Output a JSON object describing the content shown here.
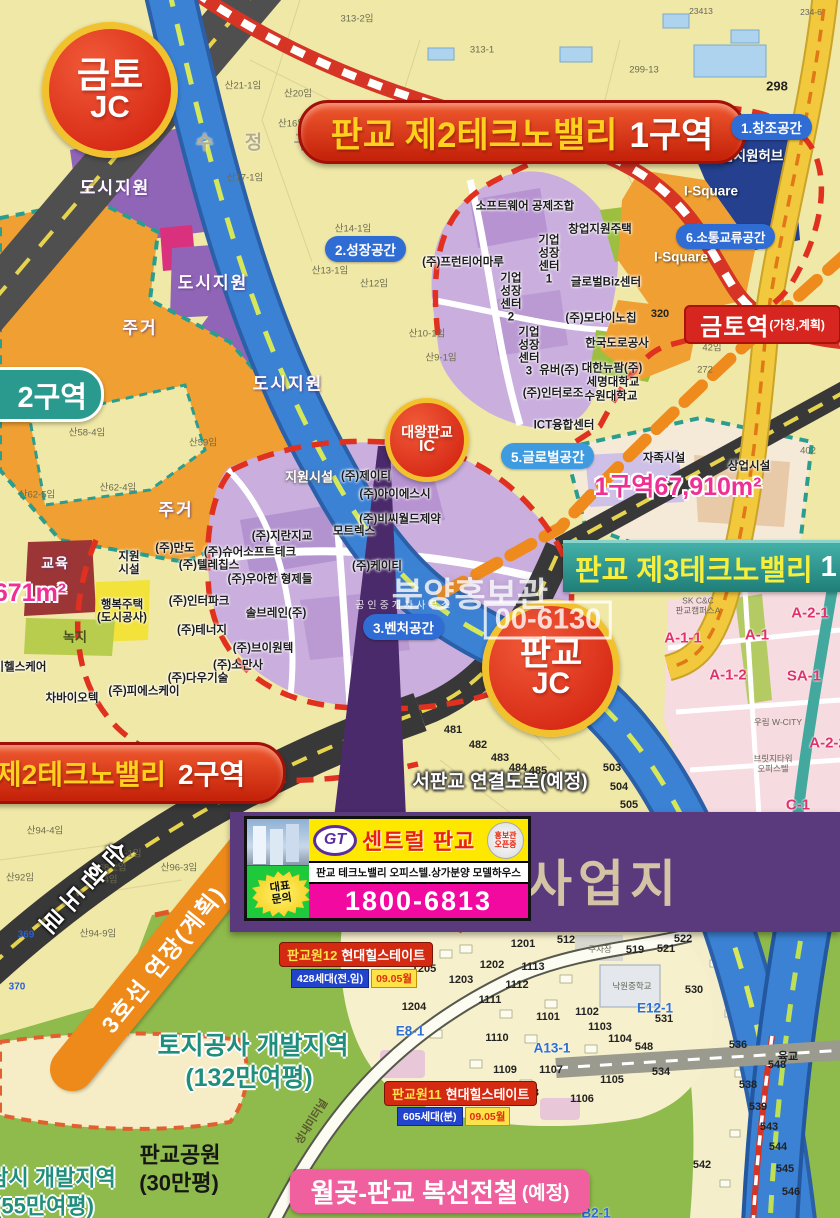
{
  "palette": {
    "map_bg": "#f0e8a6",
    "zone_residential": "#f0a032",
    "zone_urban_support": "#9065b8",
    "zone_company": "#c9aede",
    "zone_hub_navy": "#24408e",
    "expressway_blue": "#3b82d4",
    "banner_red": "#d5301c",
    "banner_teal": "#2e9599",
    "badge_blue": "#2f6cd4",
    "accent_pink": "#ef2f94",
    "park_green": "#8fba4c",
    "ad_magenta": "#f20aa0",
    "ad_yellow": "#ffe800",
    "site_band_purple": "#5a3a7d"
  },
  "junctions": {
    "geumto_jc": {
      "line1": "금토",
      "line2": "JC"
    },
    "pangyo_jc": {
      "line1": "판교",
      "line2": "JC"
    },
    "daewang_ic": {
      "line1": "대왕판교",
      "line2": "IC"
    }
  },
  "banners": {
    "tv2_zone1": {
      "prefix": "판교 제2테크노밸리",
      "suffix": "1구역"
    },
    "tv2_zone2": {
      "prefix": "제2테크노밸리",
      "suffix": "2구역"
    },
    "tv3": {
      "text": "판교 제3테크노밸리",
      "suffix": "1"
    },
    "zone2_badge": "2구역",
    "wolgot": {
      "text": "월곶-판교 복선전철",
      "note": "(예정)"
    }
  },
  "station": {
    "name": "금토역",
    "note": "(가칭,계획)"
  },
  "space_badges": {
    "s1": "1.창조공간",
    "s2": "2.성장공간",
    "s3": "3.벤처공간",
    "s5": "5.글로벌공간",
    "s6": "6.소통교류공간"
  },
  "ad": {
    "logo": "GT",
    "brand": "센트럴 판교",
    "ribbon_line1": "홍보관",
    "ribbon_line2": "오픈중",
    "desc": "판교 테크노밸리 오피스텔.상가분양 모델하우스",
    "contact_line1": "대표",
    "contact_line2": "문의",
    "phone": "1800-6813"
  },
  "site_label": "사업지",
  "apartments": {
    "pg12": {
      "name_prefix": "판교원12",
      "name": "현대힐스테이트",
      "units": "428세대(전.임)",
      "date": "09.05월"
    },
    "pg11": {
      "name_prefix": "판교원11",
      "name": "현대힐스테이트",
      "units": "605세대(분)",
      "date": "09.05월"
    }
  },
  "roads": {
    "ring": "순환도로",
    "line3": "3호선 연장(계획)"
  },
  "watermark": {
    "line1": "분양홍보관",
    "line2": "공인중개사사무소",
    "line3": "00-6130"
  },
  "map_labels": [
    {
      "t": "지원시설",
      "x": 309,
      "y": 478,
      "c": "co-w"
    },
    {
      "t": "(주)제이티",
      "x": 366,
      "y": 477,
      "c": "co"
    },
    {
      "t": "(주)아이에스시",
      "x": 395,
      "y": 495,
      "c": "co"
    },
    {
      "t": "(주)비씨월드제약",
      "x": 400,
      "y": 520,
      "c": "co"
    },
    {
      "t": "모트렉스",
      "x": 354,
      "y": 532,
      "c": "co"
    },
    {
      "t": "(주)지란지교",
      "x": 282,
      "y": 537,
      "c": "co"
    },
    {
      "t": "(주)만도",
      "x": 175,
      "y": 549,
      "c": "co"
    },
    {
      "t": "(주)슈어소프트테크",
      "x": 250,
      "y": 553,
      "c": "co"
    },
    {
      "t": "(주)텔레칩스",
      "x": 209,
      "y": 566,
      "c": "co"
    },
    {
      "t": "(주)우아한 형제들",
      "x": 270,
      "y": 580,
      "c": "co"
    },
    {
      "t": "(주)인터파크",
      "x": 199,
      "y": 602,
      "c": "co"
    },
    {
      "t": "솔브레인(주)",
      "x": 276,
      "y": 614,
      "c": "co"
    },
    {
      "t": "(주)테너지",
      "x": 202,
      "y": 631,
      "c": "co"
    },
    {
      "t": "(주)브이원텍",
      "x": 263,
      "y": 649,
      "c": "co"
    },
    {
      "t": "(주)소만사",
      "x": 238,
      "y": 666,
      "c": "co"
    },
    {
      "t": "(주)다우기술",
      "x": 198,
      "y": 679,
      "c": "co"
    },
    {
      "t": "(주)피에스케이",
      "x": 144,
      "y": 692,
      "c": "co"
    },
    {
      "t": "차바이오텍",
      "x": 72,
      "y": 699,
      "c": "co"
    },
    {
      "t": "이헬스케어",
      "x": 20,
      "y": 668,
      "c": "co"
    },
    {
      "t": "(주)케이티",
      "x": 377,
      "y": 567,
      "c": "co"
    },
    {
      "t": "행복주택\n(도시공사)",
      "x": 122,
      "y": 612,
      "c": "co"
    },
    {
      "t": "지원\n시설",
      "x": 129,
      "y": 564,
      "c": "co"
    },
    {
      "t": "소프트웨어 공제조합",
      "x": 525,
      "y": 207,
      "c": "co"
    },
    {
      "t": "창업지원주택",
      "x": 600,
      "y": 230,
      "c": "co"
    },
    {
      "t": "(주)프런티어마루",
      "x": 463,
      "y": 263,
      "c": "co"
    },
    {
      "t": "기업\n성장\n센터\n1",
      "x": 549,
      "y": 260,
      "c": "co"
    },
    {
      "t": "기업\n성장\n센터\n2",
      "x": 511,
      "y": 298,
      "c": "co"
    },
    {
      "t": "기업\n성장\n센터\n3",
      "x": 529,
      "y": 352,
      "c": "co"
    },
    {
      "t": "글로벌Biz센터",
      "x": 606,
      "y": 283,
      "c": "co"
    },
    {
      "t": "(주)모다이노칩",
      "x": 601,
      "y": 319,
      "c": "co"
    },
    {
      "t": "한국도로공사",
      "x": 617,
      "y": 344,
      "c": "co"
    },
    {
      "t": "유버(주)",
      "x": 559,
      "y": 371,
      "c": "co"
    },
    {
      "t": "대한뉴팜(주)",
      "x": 612,
      "y": 369,
      "c": "co"
    },
    {
      "t": "세명대학교",
      "x": 613,
      "y": 383,
      "c": "co"
    },
    {
      "t": "(주)인터로조",
      "x": 553,
      "y": 394,
      "c": "co"
    },
    {
      "t": "수원대학교",
      "x": 611,
      "y": 397,
      "c": "co"
    },
    {
      "t": "ICT융합센터",
      "x": 564,
      "y": 426,
      "c": "co"
    },
    {
      "t": "자족시설",
      "x": 664,
      "y": 459,
      "c": "co"
    },
    {
      "t": "상업시설",
      "x": 749,
      "y": 467,
      "c": "co"
    },
    {
      "t": "기업지원허브",
      "x": 746,
      "y": 156,
      "c": "co-wt"
    },
    {
      "t": "I-Square",
      "x": 711,
      "y": 191,
      "c": "co-wt"
    },
    {
      "t": "I-Square",
      "x": 681,
      "y": 257,
      "c": "co-wt"
    },
    {
      "t": "도시지원",
      "x": 115,
      "y": 188,
      "c": "ar"
    },
    {
      "t": "도시지원",
      "x": 213,
      "y": 283,
      "c": "ar"
    },
    {
      "t": "도시지원",
      "x": 288,
      "y": 384,
      "c": "ar"
    },
    {
      "t": "주거",
      "x": 140,
      "y": 328,
      "c": "ar"
    },
    {
      "t": "주거",
      "x": 176,
      "y": 510,
      "c": "ar"
    },
    {
      "t": "교육",
      "x": 55,
      "y": 564,
      "c": "ar ar-sm"
    },
    {
      "t": "녹지",
      "x": 75,
      "y": 638,
      "c": "ar-g"
    },
    {
      "t": "수 정 구",
      "x": 260,
      "y": 143,
      "c": "gu"
    },
    {
      "t": "671m²",
      "x": 30,
      "y": 593,
      "c": "pink-big"
    },
    {
      "t": "1구역67,910m²",
      "x": 678,
      "y": 487,
      "c": "pink-big"
    },
    {
      "t": "서판교 연결도로(예정)",
      "x": 500,
      "y": 782,
      "c": "road-w"
    },
    {
      "t": "성내미터널",
      "x": 312,
      "y": 1122,
      "c": "tunnel",
      "r": -58
    },
    {
      "t": "육교",
      "x": 788,
      "y": 1057,
      "c": "pc-k"
    },
    {
      "t": "토지공사 개발지역",
      "x": 253,
      "y": 1046,
      "c": "teal-big"
    },
    {
      "t": "(132만여평)",
      "x": 249,
      "y": 1078,
      "c": "teal-big"
    },
    {
      "t": "판교공원",
      "x": 180,
      "y": 1156,
      "c": "black-big"
    },
    {
      "t": "(30만평)",
      "x": 179,
      "y": 1184,
      "c": "black-big"
    },
    {
      "t": "남시 개발지역",
      "x": 52,
      "y": 1179,
      "c": "teal-big teal-sm"
    },
    {
      "t": "(55만여평)",
      "x": 44,
      "y": 1207,
      "c": "teal-big teal-sm"
    },
    {
      "t": "313-2임",
      "x": 357,
      "y": 20,
      "c": "pc"
    },
    {
      "t": "313-1",
      "x": 482,
      "y": 51,
      "c": "pc"
    },
    {
      "t": "299-13",
      "x": 644,
      "y": 71,
      "c": "pc"
    },
    {
      "t": "23413",
      "x": 701,
      "y": 12,
      "c": "pc-t"
    },
    {
      "t": "234-6",
      "x": 811,
      "y": 13,
      "c": "pc-t"
    },
    {
      "t": "298",
      "x": 777,
      "y": 87,
      "c": "pc-k big298"
    },
    {
      "t": "산21-1임",
      "x": 243,
      "y": 87,
      "c": "pc"
    },
    {
      "t": "산20임",
      "x": 298,
      "y": 95,
      "c": "pc"
    },
    {
      "t": "산16임",
      "x": 292,
      "y": 125,
      "c": "pc"
    },
    {
      "t": "산17-1임",
      "x": 245,
      "y": 179,
      "c": "pc"
    },
    {
      "t": "산14-1임",
      "x": 353,
      "y": 230,
      "c": "pc"
    },
    {
      "t": "산13-1임",
      "x": 330,
      "y": 272,
      "c": "pc"
    },
    {
      "t": "산12임",
      "x": 374,
      "y": 285,
      "c": "pc"
    },
    {
      "t": "산10-1임",
      "x": 427,
      "y": 335,
      "c": "pc"
    },
    {
      "t": "산9-1임",
      "x": 441,
      "y": 359,
      "c": "pc"
    },
    {
      "t": "산58-4임",
      "x": 87,
      "y": 434,
      "c": "pc"
    },
    {
      "t": "산59임",
      "x": 203,
      "y": 444,
      "c": "pc"
    },
    {
      "t": "산62-5임",
      "x": 37,
      "y": 496,
      "c": "pc"
    },
    {
      "t": "산62-4임",
      "x": 118,
      "y": 489,
      "c": "pc"
    },
    {
      "t": "320",
      "x": 660,
      "y": 314,
      "c": "pc-k"
    },
    {
      "t": "42임",
      "x": 712,
      "y": 349,
      "c": "pc"
    },
    {
      "t": "272",
      "x": 705,
      "y": 371,
      "c": "pc"
    },
    {
      "t": "402",
      "x": 808,
      "y": 452,
      "c": "pc"
    },
    {
      "t": "산94-4임",
      "x": 45,
      "y": 832,
      "c": "pc"
    },
    {
      "t": "364-1임",
      "x": 125,
      "y": 855,
      "c": "pc"
    },
    {
      "t": "368-2임",
      "x": 110,
      "y": 869,
      "c": "pc"
    },
    {
      "t": "368-4임",
      "x": 101,
      "y": 881,
      "c": "pc"
    },
    {
      "t": "산96-3임",
      "x": 179,
      "y": 869,
      "c": "pc"
    },
    {
      "t": "산92임",
      "x": 20,
      "y": 879,
      "c": "pc"
    },
    {
      "t": "산94-9임",
      "x": 98,
      "y": 935,
      "c": "pc"
    },
    {
      "t": "369",
      "x": 26,
      "y": 935,
      "c": "pc-b"
    },
    {
      "t": "370",
      "x": 17,
      "y": 987,
      "c": "pc-b"
    },
    {
      "t": "481",
      "x": 453,
      "y": 730,
      "c": "pc-k"
    },
    {
      "t": "482",
      "x": 478,
      "y": 745,
      "c": "pc-k"
    },
    {
      "t": "483",
      "x": 500,
      "y": 758,
      "c": "pc-k"
    },
    {
      "t": "484",
      "x": 518,
      "y": 768,
      "c": "pc-k"
    },
    {
      "t": "485",
      "x": 538,
      "y": 771,
      "c": "pc-k"
    },
    {
      "t": "503",
      "x": 612,
      "y": 768,
      "c": "pc-k"
    },
    {
      "t": "504",
      "x": 619,
      "y": 787,
      "c": "pc-k"
    },
    {
      "t": "505",
      "x": 629,
      "y": 805,
      "c": "pc-k"
    },
    {
      "t": "512",
      "x": 566,
      "y": 940,
      "c": "pc-k"
    },
    {
      "t": "519",
      "x": 635,
      "y": 950,
      "c": "pc-k"
    },
    {
      "t": "521",
      "x": 666,
      "y": 949,
      "c": "pc-k"
    },
    {
      "t": "522",
      "x": 683,
      "y": 939,
      "c": "pc-k"
    },
    {
      "t": "530",
      "x": 694,
      "y": 990,
      "c": "pc-k"
    },
    {
      "t": "531",
      "x": 664,
      "y": 1019,
      "c": "pc-k"
    },
    {
      "t": "534",
      "x": 661,
      "y": 1072,
      "c": "pc-k"
    },
    {
      "t": "536",
      "x": 738,
      "y": 1045,
      "c": "pc-k"
    },
    {
      "t": "538",
      "x": 748,
      "y": 1085,
      "c": "pc-k"
    },
    {
      "t": "539",
      "x": 758,
      "y": 1107,
      "c": "pc-k"
    },
    {
      "t": "542",
      "x": 702,
      "y": 1165,
      "c": "pc-k"
    },
    {
      "t": "543",
      "x": 769,
      "y": 1127,
      "c": "pc-k"
    },
    {
      "t": "544",
      "x": 778,
      "y": 1147,
      "c": "pc-k"
    },
    {
      "t": "545",
      "x": 785,
      "y": 1169,
      "c": "pc-k"
    },
    {
      "t": "546",
      "x": 791,
      "y": 1192,
      "c": "pc-k"
    },
    {
      "t": "548",
      "x": 644,
      "y": 1047,
      "c": "pc-k"
    },
    {
      "t": "548",
      "x": 777,
      "y": 1065,
      "c": "pc-k"
    },
    {
      "t": "1201",
      "x": 523,
      "y": 944,
      "c": "pc-k"
    },
    {
      "t": "1202",
      "x": 492,
      "y": 965,
      "c": "pc-k"
    },
    {
      "t": "1203",
      "x": 461,
      "y": 980,
      "c": "pc-k"
    },
    {
      "t": "1204",
      "x": 414,
      "y": 1007,
      "c": "pc-k"
    },
    {
      "t": "1205",
      "x": 424,
      "y": 969,
      "c": "pc-k"
    },
    {
      "t": "1113",
      "x": 533,
      "y": 967,
      "c": "pc-k"
    },
    {
      "t": "1112",
      "x": 517,
      "y": 985,
      "c": "pc-k"
    },
    {
      "t": "1111",
      "x": 490,
      "y": 1000,
      "c": "pc-k"
    },
    {
      "t": "1110",
      "x": 497,
      "y": 1038,
      "c": "pc-k"
    },
    {
      "t": "1109",
      "x": 505,
      "y": 1070,
      "c": "pc-k"
    },
    {
      "t": "1108",
      "x": 527,
      "y": 1093,
      "c": "pc-k"
    },
    {
      "t": "1107",
      "x": 551,
      "y": 1070,
      "c": "pc-k"
    },
    {
      "t": "1106",
      "x": 582,
      "y": 1099,
      "c": "pc-k"
    },
    {
      "t": "1105",
      "x": 612,
      "y": 1080,
      "c": "pc-k"
    },
    {
      "t": "1104",
      "x": 620,
      "y": 1039,
      "c": "pc-k"
    },
    {
      "t": "1103",
      "x": 600,
      "y": 1027,
      "c": "pc-k"
    },
    {
      "t": "1102",
      "x": 587,
      "y": 1012,
      "c": "pc-k"
    },
    {
      "t": "1101",
      "x": 548,
      "y": 1017,
      "c": "pc-k"
    },
    {
      "t": "A13-1",
      "x": 552,
      "y": 1048,
      "c": "blue-big"
    },
    {
      "t": "E8-1",
      "x": 410,
      "y": 1031,
      "c": "blue-big"
    },
    {
      "t": "E12-1",
      "x": 655,
      "y": 1008,
      "c": "blue-big"
    },
    {
      "t": "B2-1",
      "x": 596,
      "y": 1213,
      "c": "blue-big"
    },
    {
      "t": "A-1-1",
      "x": 683,
      "y": 639,
      "c": "zone-pink"
    },
    {
      "t": "A-1",
      "x": 757,
      "y": 636,
      "c": "zone-pink"
    },
    {
      "t": "A-1-2",
      "x": 728,
      "y": 676,
      "c": "zone-pink"
    },
    {
      "t": "SA-1",
      "x": 804,
      "y": 677,
      "c": "zone-pink"
    },
    {
      "t": "A-2-1",
      "x": 810,
      "y": 614,
      "c": "zone-pink"
    },
    {
      "t": "A-2-2",
      "x": 828,
      "y": 744,
      "c": "zone-pink"
    },
    {
      "t": "C-1",
      "x": 798,
      "y": 806,
      "c": "zone-pink"
    },
    {
      "t": "주차장",
      "x": 600,
      "y": 950,
      "c": "pc-t"
    },
    {
      "t": "낙원중학교",
      "x": 632,
      "y": 987,
      "c": "pc-t"
    },
    {
      "t": "브릿지타워\n오피스텔",
      "x": 773,
      "y": 764,
      "c": "pc-t"
    },
    {
      "t": "우림 W-CITY",
      "x": 778,
      "y": 723,
      "c": "pc-t"
    },
    {
      "t": "SK C&C\n판교캠퍼스A",
      "x": 698,
      "y": 606,
      "c": "pc-t"
    }
  ]
}
